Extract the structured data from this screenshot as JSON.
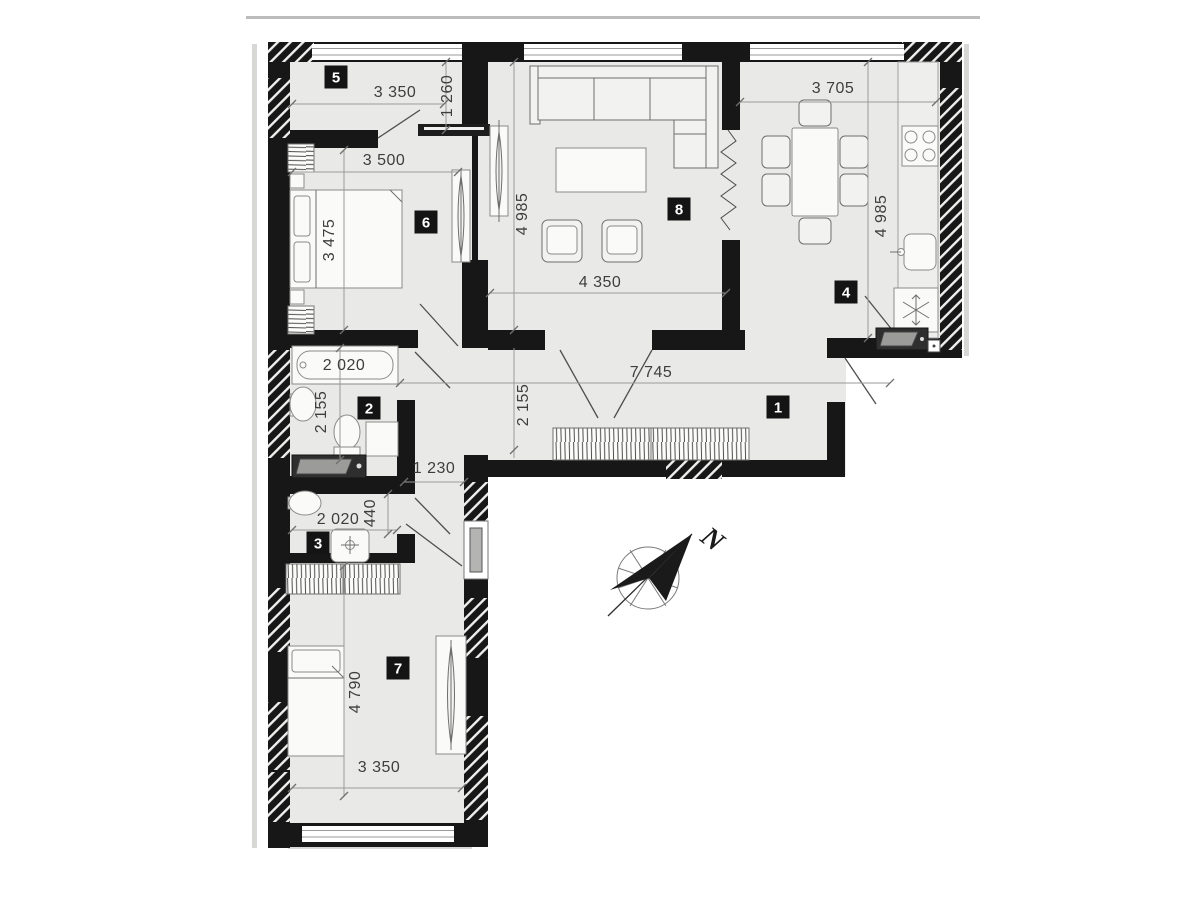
{
  "colors": {
    "wall": "#171717",
    "floor": "#e9e9e7",
    "paper": "#ffffff"
  },
  "plan": {
    "compass": {
      "label": "N",
      "arrow_direction": "north-east"
    },
    "rooms": [
      {
        "number": "5"
      },
      {
        "number": "6"
      },
      {
        "number": "8"
      },
      {
        "number": "4"
      },
      {
        "number": "2"
      },
      {
        "number": "1"
      },
      {
        "number": "3"
      },
      {
        "number": "7"
      }
    ],
    "dimensions": [
      {
        "text": "3 350"
      },
      {
        "text": "1 260"
      },
      {
        "text": "3 500"
      },
      {
        "text": "3 475"
      },
      {
        "text": "4 985"
      },
      {
        "text": "4 350"
      },
      {
        "text": "3 705"
      },
      {
        "text": "4 985"
      },
      {
        "text": "2 020"
      },
      {
        "text": "2 155"
      },
      {
        "text": "7 745"
      },
      {
        "text": "2 155"
      },
      {
        "text": "1 230"
      },
      {
        "text": "440"
      },
      {
        "text": "2 020"
      },
      {
        "text": "4 790"
      },
      {
        "text": "3 350"
      }
    ]
  }
}
